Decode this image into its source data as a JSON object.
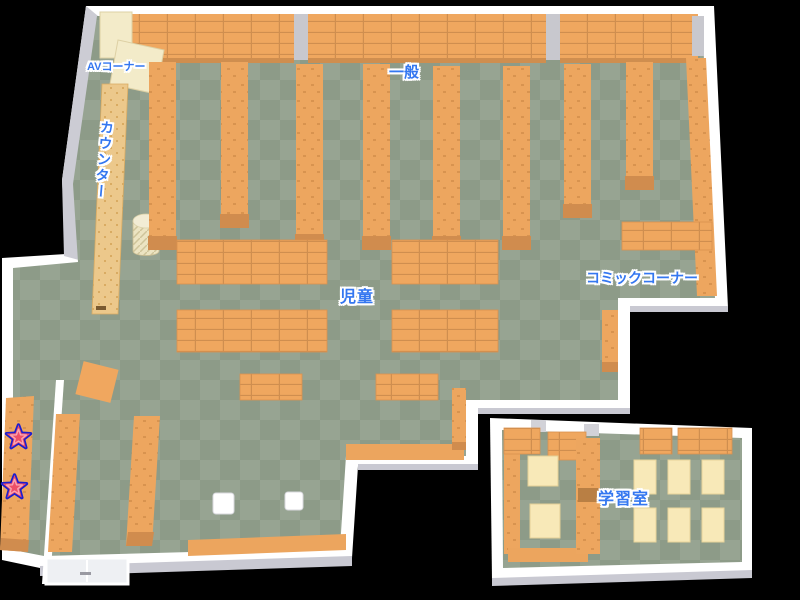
{
  "map": {
    "type": "library-floor-map",
    "labels": {
      "av_corner": "AVコーナー",
      "general": "一般",
      "counter": "カウンター",
      "children": "児童",
      "comic_corner": "コミックコーナー",
      "study_room": "学習室"
    },
    "markers": {
      "star_count": 2,
      "star_icon": "★"
    },
    "colors": {
      "background": "#000000",
      "floor_light": "#97a492",
      "floor_dark": "#8d9b88",
      "wall": "#ffffff",
      "wall_shade": "#c9c9d2",
      "bookshelf": "#efa75f",
      "bookshelf_line": "#cf8e4f",
      "bookshelf_base": "#d08c4e",
      "cream_shelf": "#f3ebc9",
      "counter_top": "#ecc88b",
      "desk": "#f8e9b8",
      "label_text": "#3477f0",
      "label_outline": "#ffffff",
      "star_fill": "#ef5068",
      "star_outline": "#1c1ecf"
    }
  }
}
